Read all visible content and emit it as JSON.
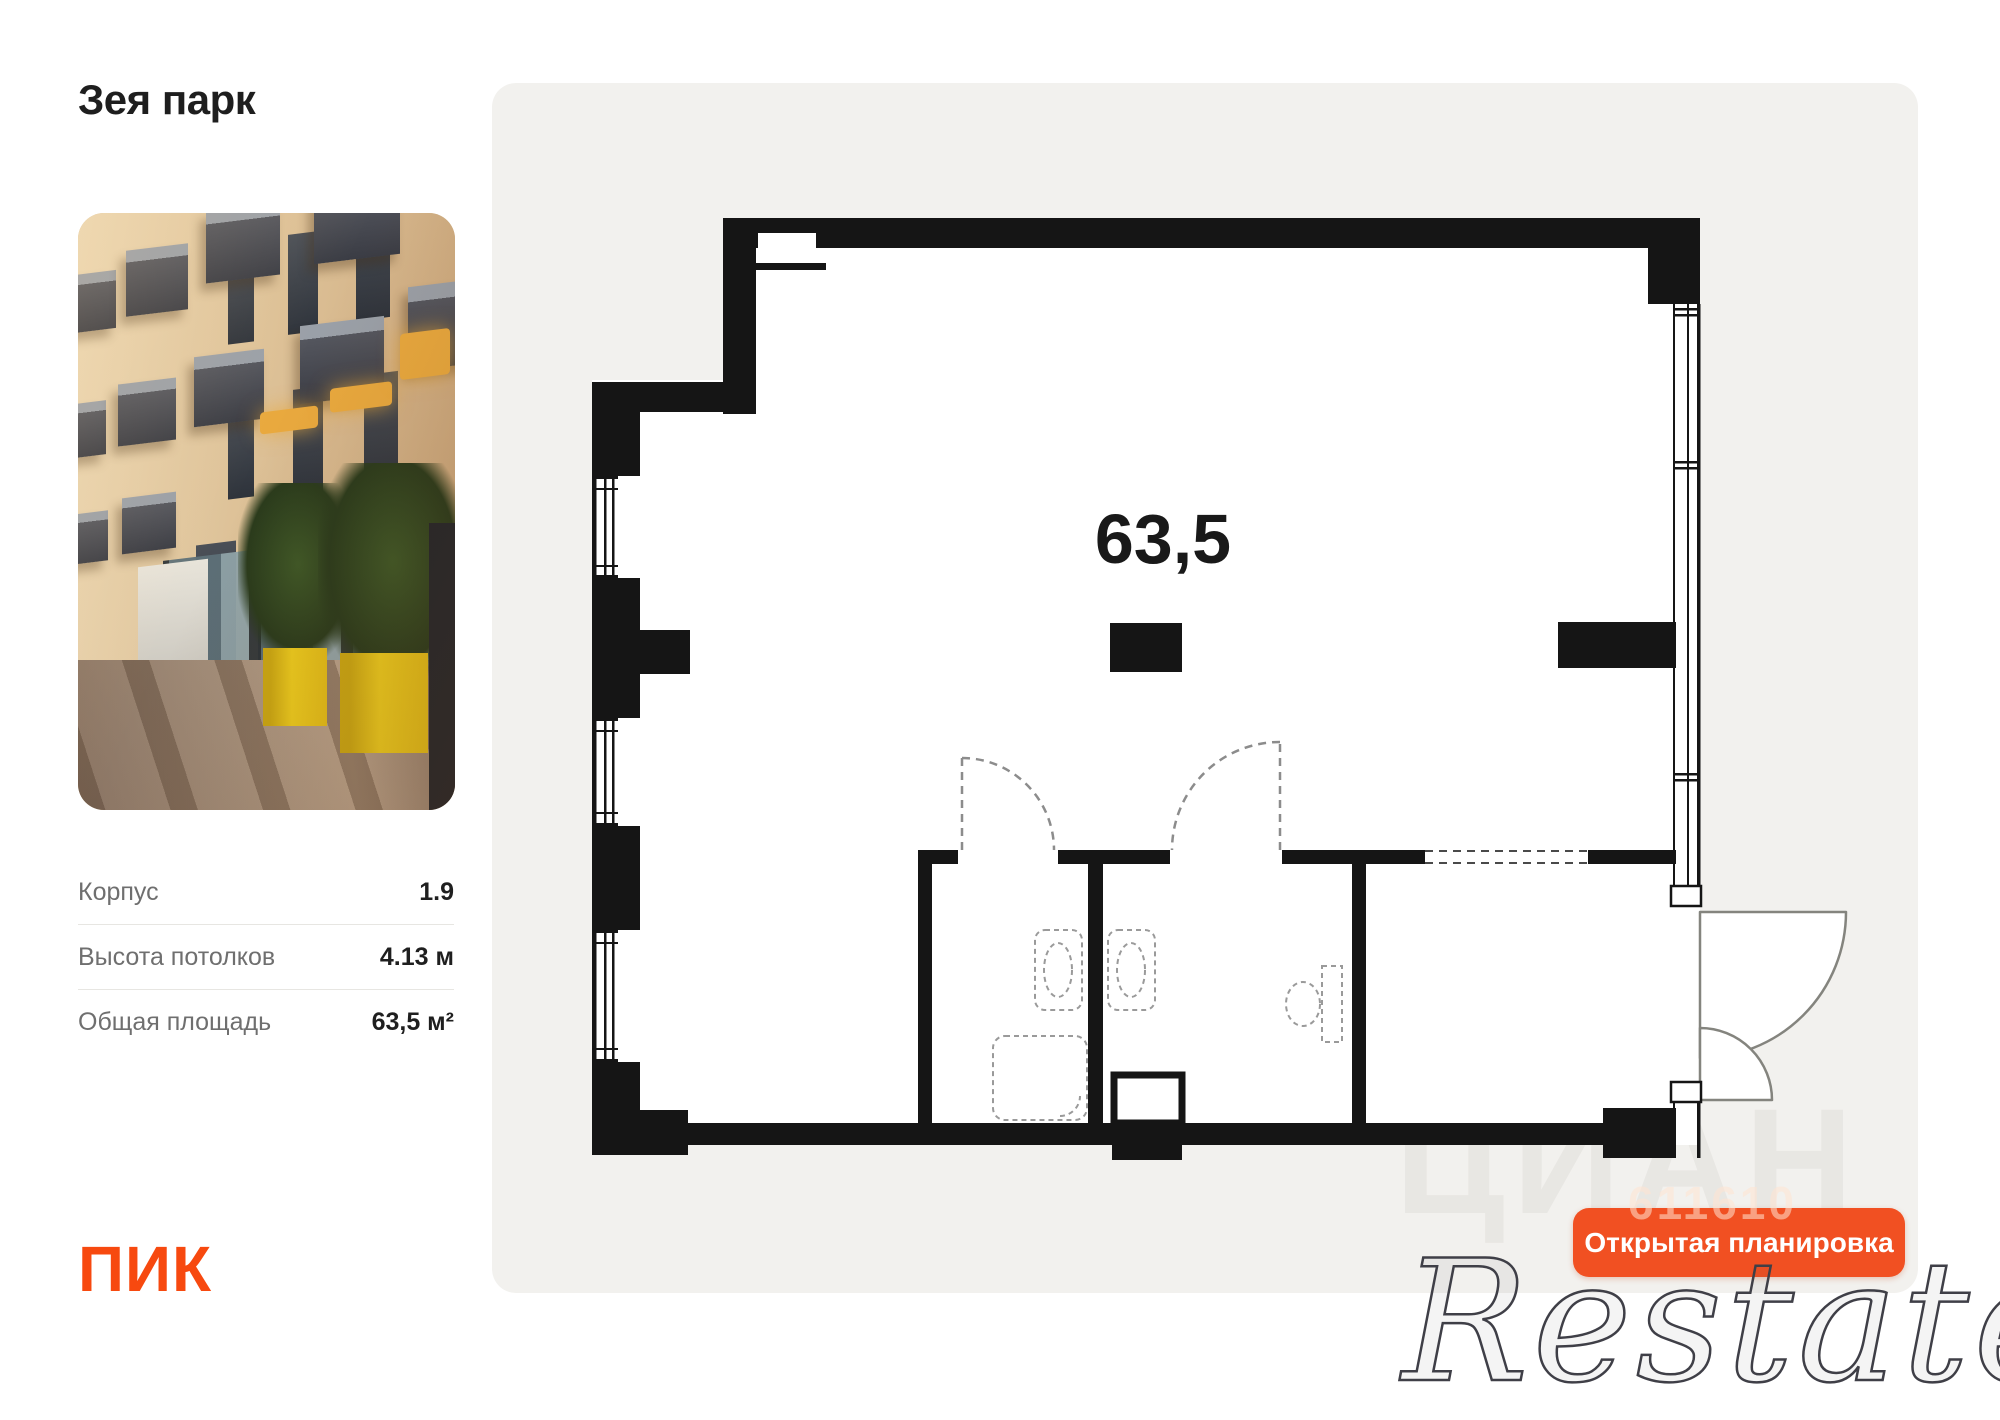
{
  "project": {
    "title": "Зея парк"
  },
  "photo": {
    "description": "building-facade-street-photo"
  },
  "specs": {
    "rows": [
      {
        "label": "Корпус",
        "value": "1.9"
      },
      {
        "label": "Высота потолков",
        "value": "4.13 м"
      },
      {
        "label": "Общая площадь",
        "value": "63,5 м²"
      }
    ]
  },
  "developer": {
    "logo_text": "ПИК"
  },
  "plan": {
    "area_label": "63,5",
    "badge_label": "Открытая планировка"
  },
  "watermarks": {
    "cian": "ЦИАН",
    "code": "611610",
    "restate": "Restate"
  },
  "colors": {
    "accent_button": "#F15022",
    "developer_logo": "#F7490F",
    "panel_background": "#F2F1EE",
    "wall": "#151515",
    "photo_yellow_planter": "#ECCB1E"
  }
}
